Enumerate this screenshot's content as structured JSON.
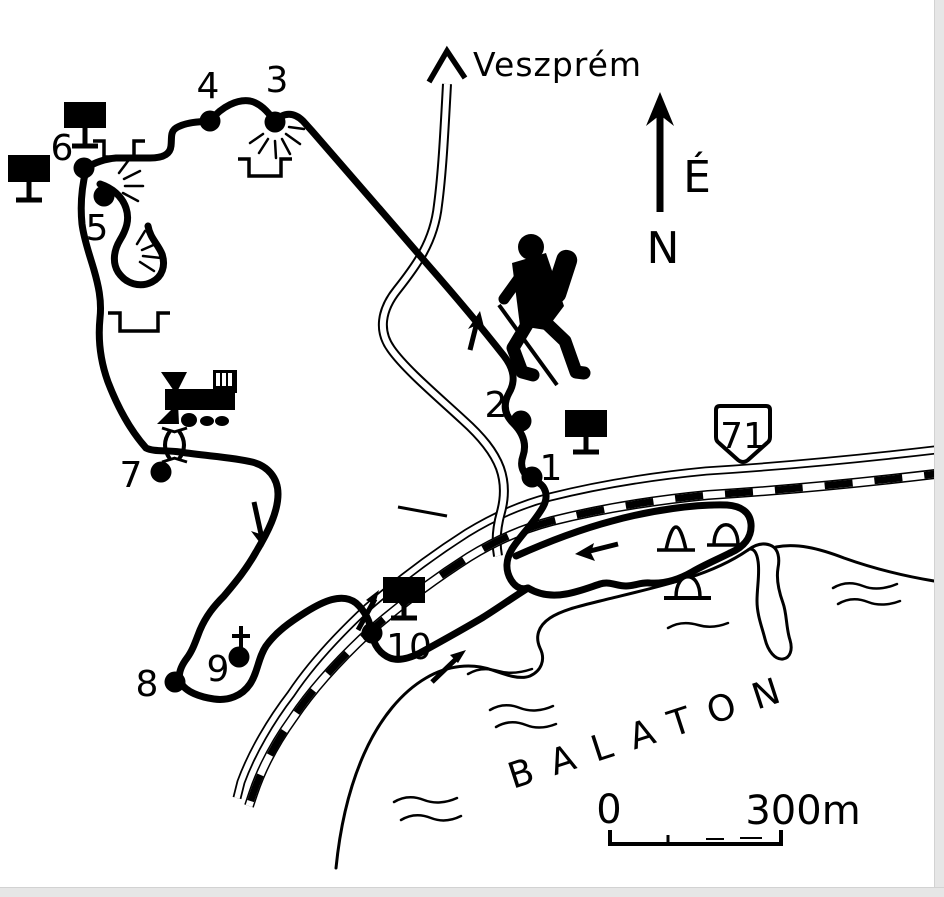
{
  "map": {
    "destination": "Veszprém",
    "compass": {
      "east_letter": "É",
      "north_letter": "N"
    },
    "road_shield": "71",
    "lake": "BALATON",
    "scale": {
      "start": "0",
      "end": "300m"
    },
    "waypoints": [
      "1",
      "2",
      "3",
      "4",
      "5",
      "6",
      "7",
      "8",
      "9",
      "10"
    ],
    "icons": [
      "north-arrow-icon",
      "hiker-icon",
      "steam-train-icon",
      "info-board-icon",
      "ruin-icon",
      "rock-rays-icon",
      "arch-monument-icon",
      "gate-icon",
      "cross-icon",
      "route-arrow-icon",
      "railway-line",
      "road-line",
      "shoreline",
      "water-waves",
      "scale-bar",
      "road-shield"
    ]
  }
}
